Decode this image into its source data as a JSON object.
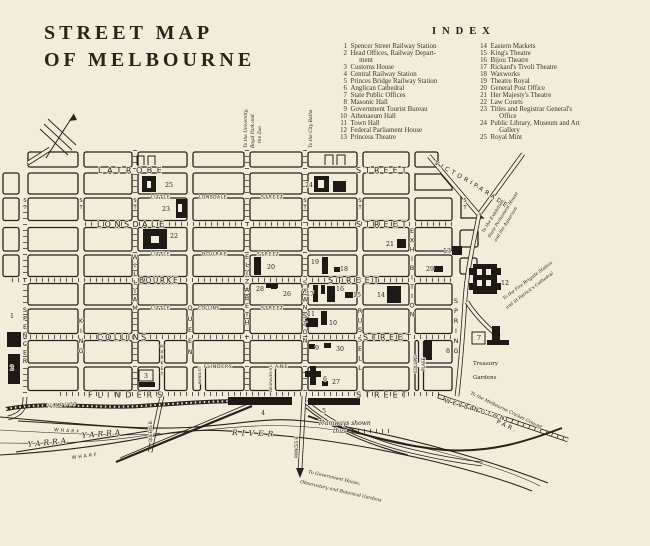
{
  "title": {
    "line1": "STREET MAP",
    "line2": "OF MELBOURNE"
  },
  "index": {
    "heading": "INDEX",
    "left": [
      {
        "num": "1",
        "label": "Spencer Street Railway Station"
      },
      {
        "num": "2",
        "label": "Head Offices, Railway Depart-\n     ment"
      },
      {
        "num": "3",
        "label": "Customs House"
      },
      {
        "num": "4",
        "label": "Central Railway Station"
      },
      {
        "num": "5",
        "label": "Princes Bridge Railway Station"
      },
      {
        "num": "6",
        "label": "Anglican Cathedral"
      },
      {
        "num": "7",
        "label": "State Public Offices"
      },
      {
        "num": "8",
        "label": "Masonic Hall"
      },
      {
        "num": "9",
        "label": "Government Tourist Bureau"
      },
      {
        "num": "10",
        "label": "Athenaeum Hall"
      },
      {
        "num": "11",
        "label": "Town Hall"
      },
      {
        "num": "12",
        "label": "Federal Parliament House"
      },
      {
        "num": "13",
        "label": "Princess Theatre"
      }
    ],
    "right": [
      {
        "num": "14",
        "label": "Eastern Markets"
      },
      {
        "num": "15",
        "label": "King's Theatre"
      },
      {
        "num": "16",
        "label": "Bijou Theatre"
      },
      {
        "num": "17",
        "label": "Rickard's Tivoli Theatre"
      },
      {
        "num": "18",
        "label": "Waxworks"
      },
      {
        "num": "19",
        "label": "Theatre Royal"
      },
      {
        "num": "20",
        "label": "General Post Office"
      },
      {
        "num": "21",
        "label": "Her Majesty's Theatre"
      },
      {
        "num": "22",
        "label": "Law Courts"
      },
      {
        "num": "23",
        "label": "Titles and Registrar General's\n     Office"
      },
      {
        "num": "24",
        "label": "Public Library, Museum and Art\n     Gallery"
      },
      {
        "num": "25",
        "label": "Royal Mint"
      }
    ]
  },
  "map": {
    "labels": [
      {
        "t": "LATROBE",
        "x": 98,
        "y": 173,
        "fs": 8,
        "ls": 4.5
      },
      {
        "t": "STREET",
        "x": 356,
        "y": 173,
        "fs": 8,
        "ls": 4
      },
      {
        "t": "LITTLE",
        "x": 151,
        "y": 198.5,
        "fs": 4.5,
        "ls": 0.8
      },
      {
        "t": "LONSDALE",
        "x": 199,
        "y": 198.5,
        "fs": 4.5,
        "ls": 0.5
      },
      {
        "t": "STREET",
        "x": 261,
        "y": 198.5,
        "fs": 4.5,
        "ls": 1
      },
      {
        "t": "LONSDALE",
        "x": 97,
        "y": 227,
        "fs": 8,
        "ls": 3.5
      },
      {
        "t": "STREET",
        "x": 356,
        "y": 227,
        "fs": 8,
        "ls": 4
      },
      {
        "t": "LITTLE",
        "x": 151,
        "y": 255.5,
        "fs": 4.5,
        "ls": 0.8
      },
      {
        "t": "BOURKE",
        "x": 202,
        "y": 255.5,
        "fs": 4.5,
        "ls": 1.2
      },
      {
        "t": "STREET",
        "x": 257,
        "y": 255.5,
        "fs": 4.5,
        "ls": 1
      },
      {
        "t": "BOURKE",
        "x": 139,
        "y": 283,
        "fs": 7.5,
        "ls": 1.5
      },
      {
        "t": "STREET",
        "x": 328,
        "y": 283,
        "fs": 8,
        "ls": 4
      },
      {
        "t": "LITTLE",
        "x": 151,
        "y": 309.5,
        "fs": 4.5,
        "ls": 0.8
      },
      {
        "t": "COLLINS",
        "x": 198,
        "y": 309.5,
        "fs": 4.5,
        "ls": 0.3
      },
      {
        "t": "STREET",
        "x": 261,
        "y": 309.5,
        "fs": 4.5,
        "ls": 1
      },
      {
        "t": "COLLINS",
        "x": 97,
        "y": 340,
        "fs": 8,
        "ls": 2.5
      },
      {
        "t": "STREET",
        "x": 363,
        "y": 340,
        "fs": 8,
        "ls": 3.5
      },
      {
        "t": "FLINDERS",
        "x": 204,
        "y": 368,
        "fs": 4.5,
        "ls": 0.8
      },
      {
        "t": "LANE",
        "x": 271,
        "y": 368,
        "fs": 4.5,
        "ls": 1.5
      },
      {
        "t": "FLINDERS",
        "x": 88,
        "y": 397.5,
        "fs": 8,
        "ls": 5
      },
      {
        "t": "STREET",
        "x": 356,
        "y": 397.5,
        "fs": 8,
        "ls": 4
      },
      {
        "t": "VICTORIA",
        "x": 434,
        "y": 164,
        "fs": 6,
        "ls": 3,
        "r": 29
      },
      {
        "t": "PARADE",
        "x": 473,
        "y": 186,
        "fs": 6,
        "ls": 3,
        "r": 33
      },
      {
        "t": "WELLINGTON",
        "x": 444,
        "y": 402,
        "fs": 6,
        "ls": 2.5,
        "r": 17
      },
      {
        "t": "PAR.",
        "x": 496,
        "y": 423,
        "fs": 6,
        "ls": 2.5,
        "r": 25
      },
      {
        "t": "VIADUCT",
        "x": 48,
        "y": 407,
        "fs": 4.4,
        "ls": 1.5,
        "i": 1,
        "r": -4
      },
      {
        "t": "WHARF",
        "x": 54,
        "y": 431,
        "fs": 4.6,
        "ls": 2,
        "r": 5
      },
      {
        "t": "WHARF",
        "x": 72,
        "y": 459,
        "fs": 4.6,
        "ls": 2,
        "r": -7
      },
      {
        "t": "YARRA",
        "x": 28,
        "y": 447,
        "fs": 7.5,
        "ls": 3,
        "i": 1,
        "r": -6,
        "f": 1
      },
      {
        "t": "YARRA",
        "x": 82,
        "y": 438,
        "fs": 7.5,
        "ls": 3,
        "i": 1,
        "r": -5,
        "f": 1
      },
      {
        "t": "RIVER",
        "x": 232,
        "y": 435,
        "fs": 7.5,
        "ls": 4,
        "i": 1,
        "r": 2,
        "f": 1
      },
      {
        "t": "Treasury",
        "x": 473,
        "y": 365,
        "fs": 5.5,
        "f": 1
      },
      {
        "t": "Gardens",
        "x": 473,
        "y": 379,
        "fs": 5.5,
        "f": 1
      },
      {
        "t": "Tramways shown",
        "x": 318,
        "y": 425,
        "fs": 6,
        "i": 1,
        "f": 1
      },
      {
        "t": "thus",
        "x": 333,
        "y": 433,
        "fs": 6,
        "i": 1,
        "f": 1
      },
      {
        "t": "To the University,",
        "x": 247,
        "y": 148,
        "fs": 4.4,
        "i": 1,
        "f": 1,
        "r": -90
      },
      {
        "t": "Royal Park and",
        "x": 254,
        "y": 148,
        "fs": 4.4,
        "i": 1,
        "f": 1,
        "r": -90
      },
      {
        "t": "the Zoo",
        "x": 261,
        "y": 143,
        "fs": 4.4,
        "i": 1,
        "f": 1,
        "r": -90
      },
      {
        "t": "To the City Baths",
        "x": 312,
        "y": 148,
        "fs": 4.4,
        "i": 1,
        "f": 1,
        "r": -90
      },
      {
        "t": "To the Exhibition,",
        "x": 484,
        "y": 233,
        "fs": 4.4,
        "i": 1,
        "f": 1,
        "r": -58
      },
      {
        "t": "State Parliament House",
        "x": 490,
        "y": 238,
        "fs": 4.4,
        "i": 1,
        "f": 1,
        "r": -58
      },
      {
        "t": "and the Aquarium",
        "x": 496,
        "y": 242,
        "fs": 4.4,
        "i": 1,
        "f": 1,
        "r": -58
      },
      {
        "t": "To the Fire Brigade Station",
        "x": 504,
        "y": 300,
        "fs": 4.4,
        "i": 1,
        "f": 1,
        "r": -37
      },
      {
        "t": "and St Patrick's Cathedral",
        "x": 507,
        "y": 309,
        "fs": 4.4,
        "i": 1,
        "f": 1,
        "r": -37
      },
      {
        "t": "To the Melbourne Cricket Ground",
        "x": 470,
        "y": 394,
        "fs": 4.6,
        "i": 1,
        "f": 1,
        "r": 26
      },
      {
        "t": "To Government House,",
        "x": 308,
        "y": 473,
        "fs": 4.6,
        "i": 1,
        "f": 1,
        "r": 13
      },
      {
        "t": "Observatory and Botanical Gardens",
        "x": 300,
        "y": 483,
        "fs": 4.6,
        "i": 1,
        "f": 1,
        "r": 13
      },
      {
        "t": "QUEENS B.",
        "x": 152,
        "y": 442,
        "fs": 4,
        "r": -90
      },
      {
        "t": "PRINCES B.",
        "x": 298,
        "y": 458,
        "fs": 4,
        "r": -90
      },
      {
        "t": "BOND ST",
        "x": 201,
        "y": 384,
        "fs": 3.8,
        "r": -90
      },
      {
        "t": "DEGRAVES ST",
        "x": 272,
        "y": 392,
        "fs": 3.8,
        "r": -90
      },
      {
        "t": "COLLINS",
        "x": 417,
        "y": 373,
        "fs": 4.2,
        "r": -90
      },
      {
        "t": "PLACE",
        "x": 425,
        "y": 371,
        "fs": 4.2,
        "r": -90
      }
    ],
    "vlabels": [
      {
        "t": "SPENCER",
        "x": 25,
        "y": 312,
        "g": 8.5,
        "fs": 6.5
      },
      {
        "t": "KING",
        "x": 81,
        "y": 323,
        "g": 10,
        "fs": 6.5
      },
      {
        "t": "WILLIAM",
        "x": 135,
        "y": 259,
        "g": 8.5,
        "fs": 6.5
      },
      {
        "t": "QUEEN",
        "x": 190,
        "y": 310,
        "g": 11,
        "fs": 6.5
      },
      {
        "t": "ELIZABETH",
        "x": 247,
        "y": 259,
        "g": 8.2,
        "fs": 6.5
      },
      {
        "t": "SWANSTON",
        "x": 305,
        "y": 285,
        "g": 8.2,
        "fs": 6.5
      },
      {
        "t": "RUSSELL",
        "x": 360,
        "y": 313,
        "g": 9.5,
        "fs": 6.5
      },
      {
        "t": "EXHIBITION",
        "x": 412,
        "y": 233,
        "g": 9.3,
        "fs": 6.5
      },
      {
        "t": "SPRING",
        "x": 456,
        "y": 303,
        "g": 10,
        "fs": 6.5
      },
      {
        "t": "MARKET",
        "x": 162,
        "y": 348,
        "g": 5.5,
        "fs": 4.4
      },
      {
        "t": "ST",
        "x": 25,
        "y": 202,
        "g": 7,
        "fs": 5
      },
      {
        "t": "ST",
        "x": 81,
        "y": 202,
        "g": 7,
        "fs": 5
      },
      {
        "t": "ST",
        "x": 135,
        "y": 202,
        "g": 7,
        "fs": 5
      },
      {
        "t": "ST",
        "x": 305,
        "y": 202,
        "g": 7,
        "fs": 5
      },
      {
        "t": "ST",
        "x": 360,
        "y": 202,
        "g": 7,
        "fs": 5
      },
      {
        "t": "ST",
        "x": 465,
        "y": 202,
        "g": 7,
        "fs": 5
      }
    ],
    "markers": [
      {
        "n": "1",
        "x": 12,
        "y": 318
      },
      {
        "n": "2",
        "x": 12,
        "y": 370
      },
      {
        "n": "3",
        "x": 146,
        "y": 378,
        "box": 1
      },
      {
        "n": "4",
        "x": 263,
        "y": 415
      },
      {
        "n": "5",
        "x": 324,
        "y": 413
      },
      {
        "n": "6",
        "x": 325,
        "y": 381
      },
      {
        "n": "7",
        "x": 479,
        "y": 340,
        "box": 1
      },
      {
        "n": "8",
        "x": 448,
        "y": 353
      },
      {
        "n": "9",
        "x": 317,
        "y": 350
      },
      {
        "n": "10",
        "x": 333,
        "y": 325
      },
      {
        "n": "11",
        "x": 311,
        "y": 316
      },
      {
        "n": "12",
        "x": 505,
        "y": 285
      },
      {
        "n": "13",
        "x": 447,
        "y": 253
      },
      {
        "n": "14",
        "x": 381,
        "y": 297
      },
      {
        "n": "15",
        "x": 357,
        "y": 297
      },
      {
        "n": "16",
        "x": 340,
        "y": 291
      },
      {
        "n": "17",
        "x": 310,
        "y": 296
      },
      {
        "n": "18",
        "x": 344,
        "y": 271
      },
      {
        "n": "19",
        "x": 315,
        "y": 264
      },
      {
        "n": "20",
        "x": 271,
        "y": 269
      },
      {
        "n": "21",
        "x": 390,
        "y": 246
      },
      {
        "n": "22",
        "x": 174,
        "y": 238
      },
      {
        "n": "23",
        "x": 166,
        "y": 211
      },
      {
        "n": "24",
        "x": 309,
        "y": 187
      },
      {
        "n": "25",
        "x": 169,
        "y": 187
      },
      {
        "n": "26",
        "x": 287,
        "y": 296
      },
      {
        "n": "27",
        "x": 336,
        "y": 384
      },
      {
        "n": "28",
        "x": 260,
        "y": 291
      },
      {
        "n": "29",
        "x": 430,
        "y": 271
      },
      {
        "n": "30",
        "x": 340,
        "y": 351
      }
    ]
  }
}
